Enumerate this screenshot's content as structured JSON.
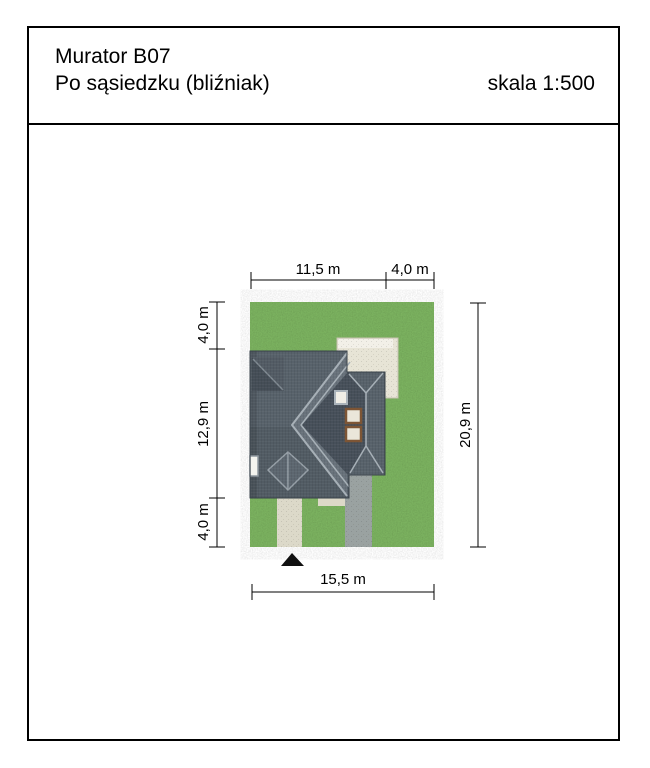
{
  "header": {
    "title_line1": "Murator B07",
    "title_line2": "Po sąsiedzku (bliźniak)",
    "scale_label": "skala 1:500"
  },
  "site_plan": {
    "dimensions": {
      "top_house_width": "11,5 m",
      "top_side_yard": "4,0 m",
      "left_top_setback": "4,0 m",
      "left_house_depth": "12,9 m",
      "left_bottom_setback": "4,0 m",
      "right_plot_depth": "20,9 m",
      "bottom_plot_width": "15,5 m"
    },
    "colors": {
      "grass_base": "#6a9a52",
      "grass_texture": "#7cb360",
      "roof_main": "#58626b",
      "roof_light": "#68727b",
      "roof_dark": "#47505a",
      "ridge_line": "#a7b0b7",
      "terrace": "#e7e4d6",
      "driveway": "#9aa2a1",
      "walkway": "#dcd9c9",
      "doorstep": "#ddd9c8",
      "marker": "#101010"
    }
  }
}
